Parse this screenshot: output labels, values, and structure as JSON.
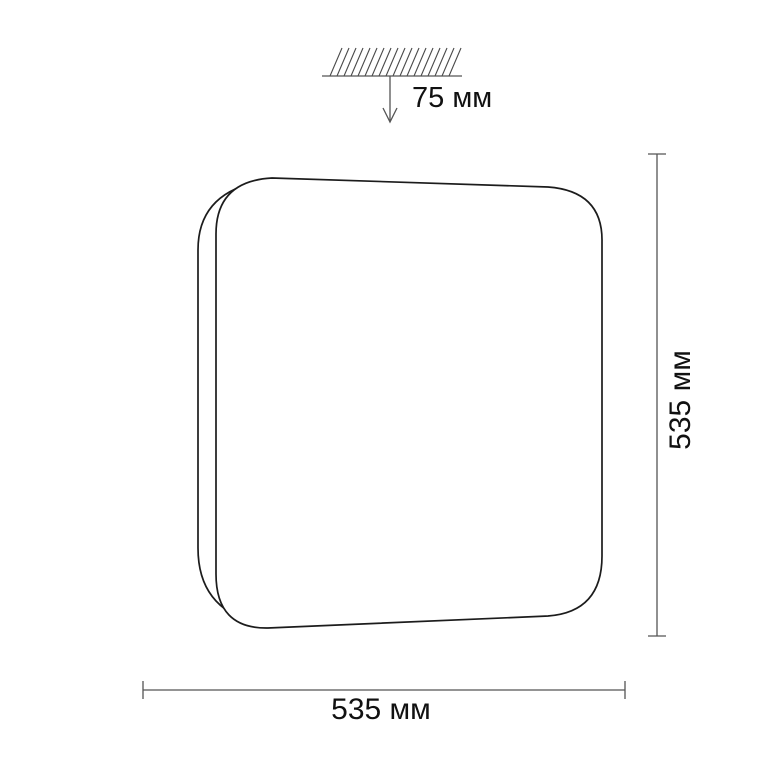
{
  "diagram": {
    "subject": "square-ceiling-light-fixture",
    "colors": {
      "outline": "#1c1c1c",
      "dimension_line": "#555555",
      "text": "#111111",
      "background": "#ffffff"
    },
    "dimensions": {
      "ceiling_offset_label": "75 мм",
      "height_label": "535 мм",
      "width_label": "535 мм"
    }
  }
}
